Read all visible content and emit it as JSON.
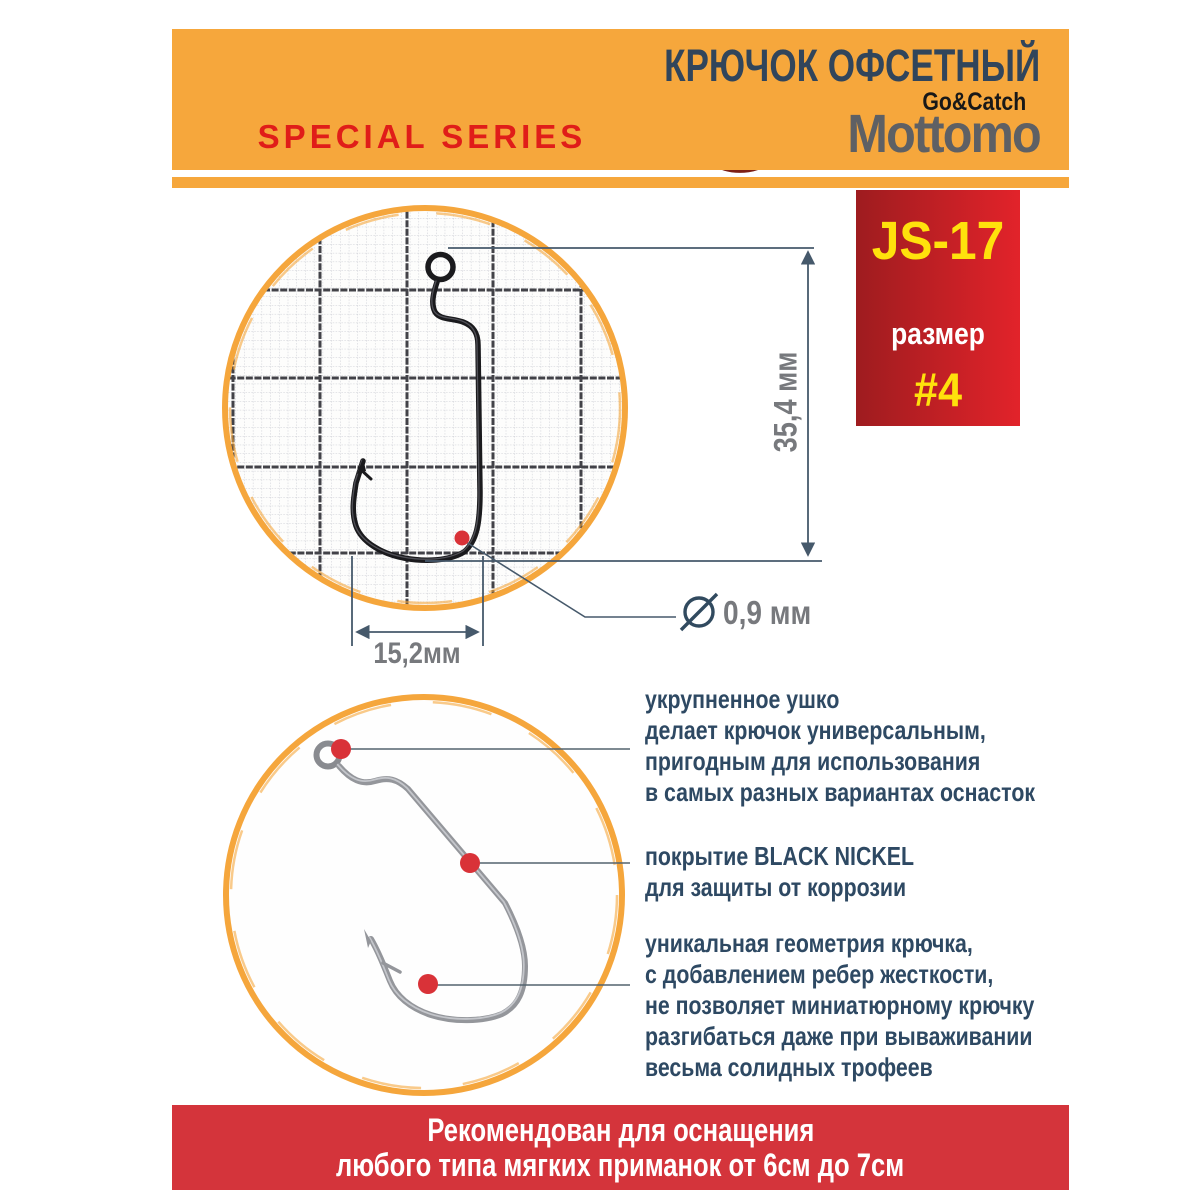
{
  "header": {
    "series": "SPECIAL SERIES",
    "title": "КРЮЧОК ОФСЕТНЫЙ",
    "brand": "Mottomo",
    "brand_tagline": "Go&Catch"
  },
  "badge": {
    "model": "JS-17",
    "size_label": "размер",
    "size_value": "#4"
  },
  "diagram": {
    "length_label": "35,4 мм",
    "width_label": "15,2мм",
    "diameter_label": "0,9 мм",
    "diameter_icon": "crossed-circle-diameter-symbol"
  },
  "annotations": [
    {
      "lines": [
        "укрупненное ушко",
        "делает крючок универсальным,",
        "пригодным для использования",
        "в самых разных вариантах оснасток"
      ]
    },
    {
      "lines": [
        "покрытие BLACK NICKEL",
        "для защиты от коррозии"
      ]
    },
    {
      "lines": [
        "уникальная геометрия крючка,",
        "с добавлением ребер жесткости,",
        "не позволяет миниатюрному крючку",
        "разгибаться даже при вываживании",
        "весьма солидных трофеев"
      ]
    }
  ],
  "footer": {
    "line1": "Рекомендован для оснащения",
    "line2": "любого типа мягких приманок от 6см до 7см"
  },
  "colors": {
    "orange": "#F6A73C",
    "red_bar": "#D4343B",
    "badge_dark": "#9E1C1F",
    "badge_bright": "#E2232A",
    "title_navy": "#31455B",
    "text_navy": "#2E4963",
    "measure_gray": "#77797D",
    "dot_red": "#D93238",
    "logo_maroon": "#7E2015",
    "hook_black": "#1A1A1D",
    "hook_silver": "#94969B"
  }
}
